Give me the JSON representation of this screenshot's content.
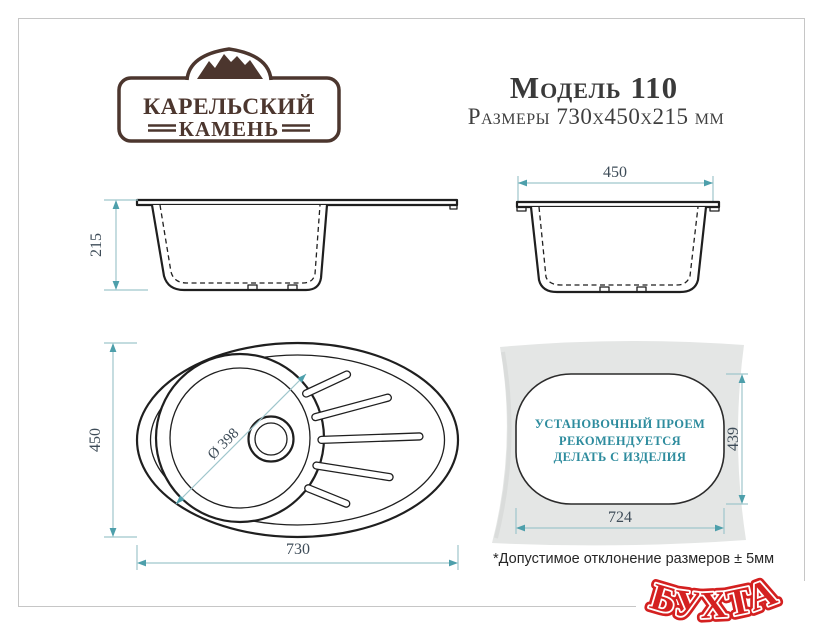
{
  "brand": {
    "name_line1": "КАРЕЛЬСКИЙ",
    "name_line2": "КАМЕНЬ"
  },
  "header": {
    "model": "Модель 110",
    "dimensions": "Размеры 730х450х215 мм"
  },
  "views": {
    "side": {
      "height": "215"
    },
    "front": {
      "width": "450"
    },
    "top": {
      "height": "450",
      "width": "730",
      "bowl_diameter": "Ø 398"
    },
    "cutout": {
      "line1": "УСТАНОВОЧНЫЙ ПРОЕМ",
      "line2": "РЕКОМЕНДУЕТСЯ",
      "line3": "ДЕЛАТЬ С ИЗДЕЛИЯ",
      "height": "439",
      "width": "724"
    }
  },
  "footnote": "*Допустимое отклонение размеров ± 5мм",
  "watermark": "БУХТА",
  "colors": {
    "drawing_line": "#1f1f1f",
    "dimension_line": "#9fc6cc",
    "dimension_arrow": "#4d9fab",
    "dimension_text": "#3e4c58",
    "note_teal": "#2e8c9e",
    "brand_brown": "#4c362e",
    "watermark_red": "#d42020",
    "template_gray": "#e4e6e5"
  }
}
